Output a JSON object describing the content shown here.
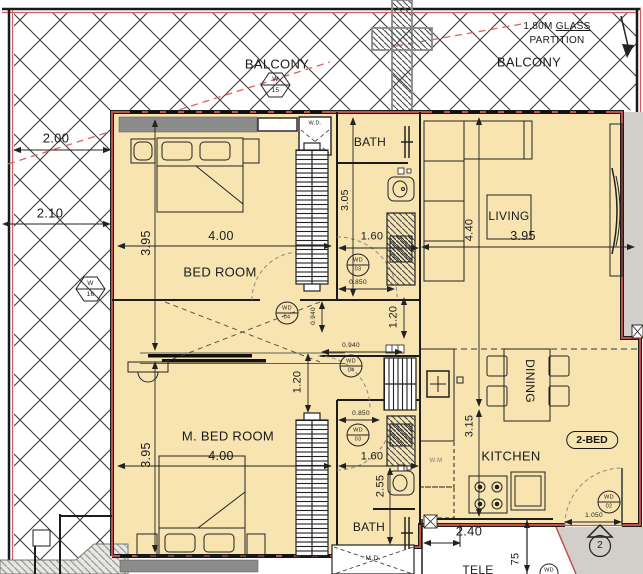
{
  "colors": {
    "room_fill": "#f7e4b0",
    "wall_red": "#c0504d",
    "exterior_gray": "#d2cfca",
    "beam_gray": "#8c8c8c",
    "hatch_line": "#3d3d3d",
    "red_dashed": "#e06060"
  },
  "rooms": {
    "balcony_left": "BALCONY",
    "balcony_right": "BALCONY",
    "bed_room": "BED ROOM",
    "m_bed_room": "M. BED ROOM",
    "bath_top": "BATH",
    "bath_bottom": "BATH",
    "living": "LIVING",
    "kitchen": "KITCHEN",
    "dining": "DINING",
    "tele": "TELE"
  },
  "glass_partition": {
    "size": "1.80M",
    "word": "GLASS",
    "line2": "PARTITION"
  },
  "unit": {
    "type_badge": "2-BED",
    "door_number": "2"
  },
  "fixtures": {
    "washing_machine": "W.M",
    "wd_box": "W.D.",
    "md_box": "M.D."
  },
  "dimensions": {
    "balcony_top": "2.00",
    "balcony_mid": "2.10",
    "bedroom_width": "4.00",
    "bedroom_depth": "3.95",
    "bath_top_depth": "3.05",
    "bath_top_width": "1.60",
    "bath_top_door": "0.850",
    "hall_passage": "0.940",
    "hall_width": "1.20",
    "hall_passage_b": "0.940",
    "mbed_wardrobe": "1.20",
    "living_depth": "4.40",
    "living_width": "3.95",
    "mbed_width": "4.00",
    "mbed_depth": "3.95",
    "bath_bottom_door": "0.850",
    "bath_bottom_width": "1.60",
    "bath_bottom_depth": "2.55",
    "kitchen_depth": "3.15",
    "entry_width": "1.050",
    "lower_unit_width": "2.40",
    "lower_unit_partial": "75"
  },
  "symbols": {
    "window_w15": {
      "code": "W",
      "num": "15"
    },
    "window_w16": {
      "code": "W",
      "num": "16"
    },
    "door_wd02": {
      "code": "WD",
      "num": "02"
    },
    "door_wd03": {
      "code": "WD",
      "num": "03"
    },
    "door_wd04": {
      "code": "WD",
      "num": "04"
    },
    "door_wd_cut": {
      "code": "WD"
    }
  }
}
